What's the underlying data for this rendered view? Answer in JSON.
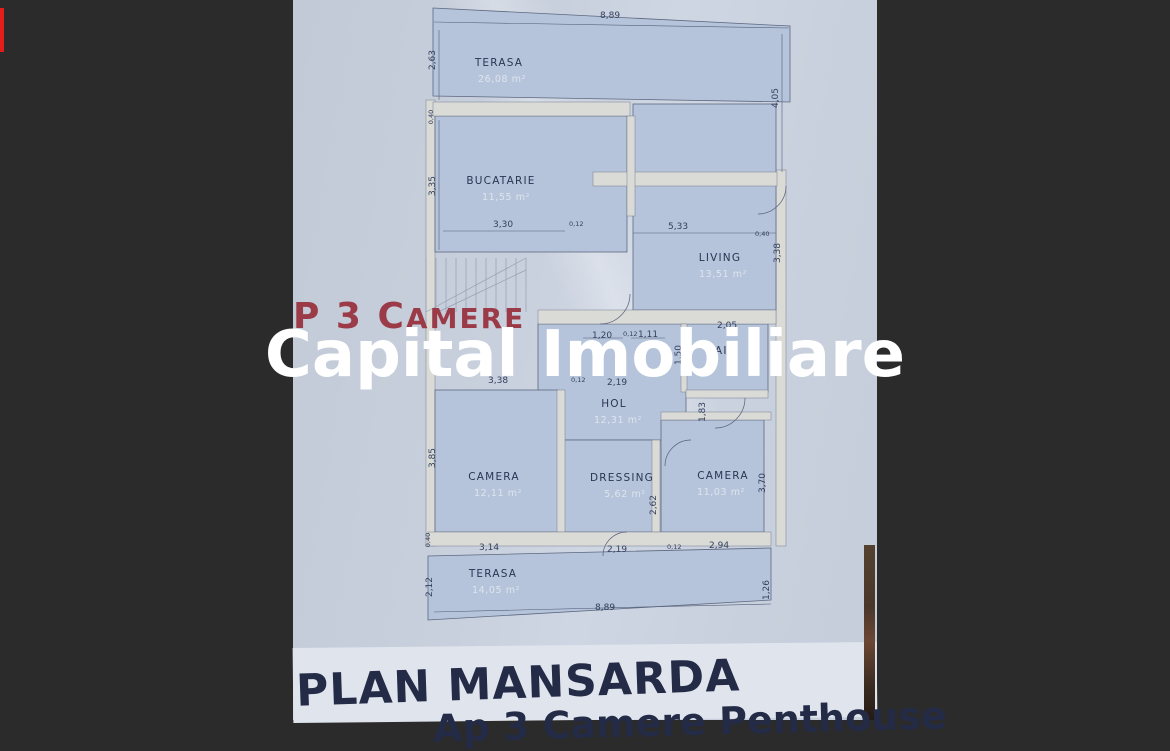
{
  "background": {
    "color": "#2b2b2b",
    "red_bar_color": "#e31c1c"
  },
  "photo": {
    "watermark": "Capital Imobiliare",
    "listing_title_big": "P 3 C",
    "listing_title_small": "AMERE",
    "plan_title": "PLAN MANSARDA",
    "plan_subtitle_partial": "Ap 3 Camere Penthouse",
    "rooms": [
      {
        "name": "TERASA",
        "area": "26,08 m²"
      },
      {
        "name": "BUCATARIE",
        "area": "11,55 m²"
      },
      {
        "name": "LIVING",
        "area": "13,51 m²"
      },
      {
        "name": "BAIE",
        "area": ""
      },
      {
        "name": "HOL",
        "area": "12,31 m²"
      },
      {
        "name": "CAMERA",
        "area": "12,11 m²"
      },
      {
        "name": "DRESSING",
        "area": "5,62 m²"
      },
      {
        "name": "CAMERA",
        "area": "11,03 m²"
      },
      {
        "name": "TERASA",
        "area": "14,05 m²"
      }
    ],
    "dims": [
      "8,89",
      "2,63",
      "4,05",
      "3,35",
      "3,30",
      "0,12",
      "5,33",
      "3,38",
      "0,40",
      "1,20",
      "0,12",
      "1,11",
      "2,05",
      "1,50",
      "3,38",
      "0,12",
      "2,19",
      "1,83",
      "3,85",
      "2,62",
      "3,70",
      "3,14",
      "2,19",
      "0,12",
      "2,94",
      "2,12",
      "1,26",
      "8,89",
      "0,40",
      "0,40"
    ]
  }
}
